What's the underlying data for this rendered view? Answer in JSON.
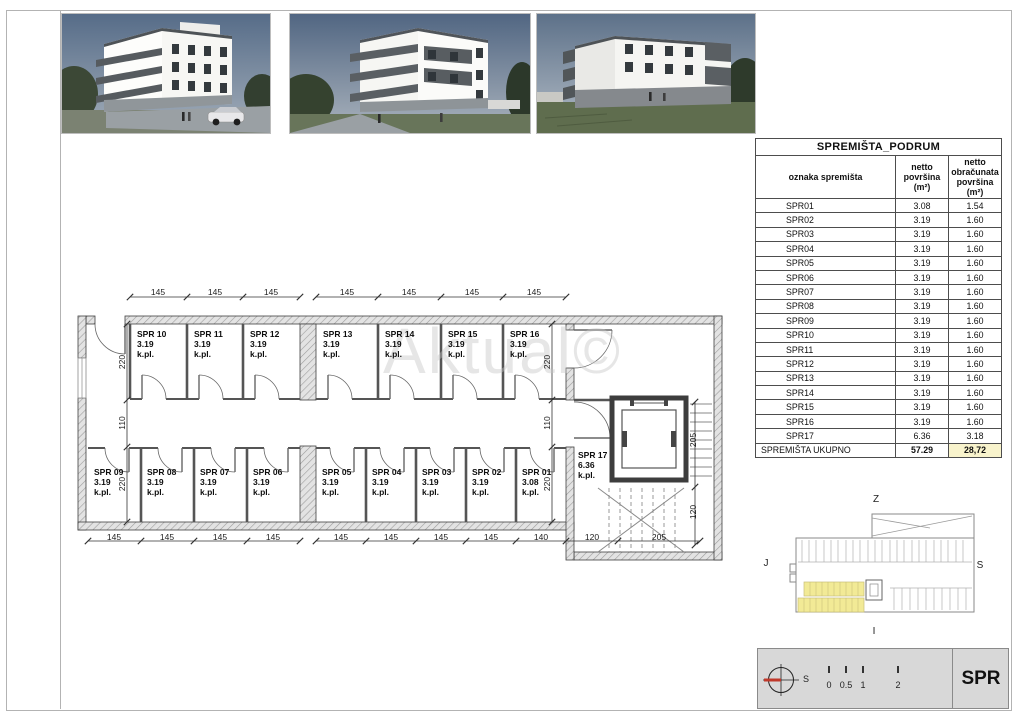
{
  "sheet": {
    "code": "SPR"
  },
  "table": {
    "title": "SPREMIŠTA_PODRUM",
    "columns": [
      "oznaka spremišta",
      "netto\npovršina (m²)",
      "netto\nobračunata\npovršina (m²)"
    ],
    "rows": [
      [
        "SPR01",
        "3.08",
        "1.54"
      ],
      [
        "SPR02",
        "3.19",
        "1.60"
      ],
      [
        "SPR03",
        "3.19",
        "1.60"
      ],
      [
        "SPR04",
        "3.19",
        "1.60"
      ],
      [
        "SPR05",
        "3.19",
        "1.60"
      ],
      [
        "SPR06",
        "3.19",
        "1.60"
      ],
      [
        "SPR07",
        "3.19",
        "1.60"
      ],
      [
        "SPR08",
        "3.19",
        "1.60"
      ],
      [
        "SPR09",
        "3.19",
        "1.60"
      ],
      [
        "SPR10",
        "3.19",
        "1.60"
      ],
      [
        "SPR11",
        "3.19",
        "1.60"
      ],
      [
        "SPR12",
        "3.19",
        "1.60"
      ],
      [
        "SPR13",
        "3.19",
        "1.60"
      ],
      [
        "SPR14",
        "3.19",
        "1.60"
      ],
      [
        "SPR15",
        "3.19",
        "1.60"
      ],
      [
        "SPR16",
        "3.19",
        "1.60"
      ],
      [
        "SPR17",
        "6.36",
        "3.18"
      ]
    ],
    "total": {
      "label": "SPREMIŠTA UKUPNO",
      "netto": "57.29",
      "obracunata": "28,72"
    }
  },
  "plan": {
    "watermark": "Aktual©",
    "rooms_top": [
      {
        "name": "SPR 10",
        "area": "3.19",
        "unit": "k.pl."
      },
      {
        "name": "SPR 11",
        "area": "3.19",
        "unit": "k.pl."
      },
      {
        "name": "SPR 12",
        "area": "3.19",
        "unit": "k.pl."
      },
      {
        "name": "SPR 13",
        "area": "3.19",
        "unit": "k.pl."
      },
      {
        "name": "SPR 14",
        "area": "3.19",
        "unit": "k.pl."
      },
      {
        "name": "SPR 15",
        "area": "3.19",
        "unit": "k.pl."
      },
      {
        "name": "SPR 16",
        "area": "3.19",
        "unit": "k.pl."
      }
    ],
    "rooms_bottom": [
      {
        "name": "SPR 09",
        "area": "3.19",
        "unit": "k.pl."
      },
      {
        "name": "SPR 08",
        "area": "3.19",
        "unit": "k.pl."
      },
      {
        "name": "SPR 07",
        "area": "3.19",
        "unit": "k.pl."
      },
      {
        "name": "SPR 06",
        "area": "3.19",
        "unit": "k.pl."
      },
      {
        "name": "SPR 05",
        "area": "3.19",
        "unit": "k.pl."
      },
      {
        "name": "SPR 04",
        "area": "3.19",
        "unit": "k.pl."
      },
      {
        "name": "SPR 03",
        "area": "3.19",
        "unit": "k.pl."
      },
      {
        "name": "SPR 02",
        "area": "3.19",
        "unit": "k.pl."
      },
      {
        "name": "SPR 01",
        "area": "3.08",
        "unit": "k.pl."
      }
    ],
    "room_stair": {
      "name": "SPR 17",
      "area": "6.36",
      "unit": "k.pl."
    },
    "dims": {
      "top": [
        "145",
        "145",
        "145",
        "145",
        "145",
        "145",
        "145"
      ],
      "bottom": [
        "145",
        "145",
        "145",
        "145",
        "145",
        "145",
        "145",
        "145",
        "140",
        "120",
        "205"
      ],
      "left": [
        "220",
        "110",
        "220"
      ],
      "right": [
        "220",
        "110",
        "220"
      ],
      "stair_right": [
        "205",
        "120"
      ]
    }
  },
  "keyplan": {
    "label_top": "Z",
    "label_left": "J",
    "label_right": "S",
    "label_bottom": "I"
  },
  "footer": {
    "compass_label": "S",
    "scale_labels": [
      "0",
      "0.5",
      "1",
      "2"
    ],
    "sheet_code": "SPR"
  },
  "colors": {
    "table_highlight": "#f8f3cc",
    "keyplan_highlight": "#f2ea96",
    "compass_red": "#c0392b",
    "footer_bg": "#d8d8d8"
  }
}
